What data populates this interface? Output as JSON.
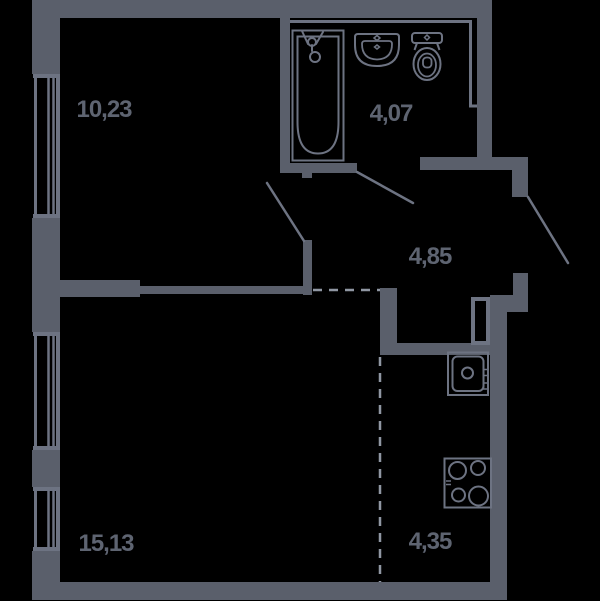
{
  "colors": {
    "bg": "#000000",
    "wall": "#5a5f6b",
    "line": "#6d7382",
    "dash": "#9097a3",
    "text": "#5e6471"
  },
  "floorplan": {
    "type": "apartment-floor-plan",
    "rooms": [
      {
        "id": "room-top-left",
        "label": "10,23",
        "area_m2": 10.23
      },
      {
        "id": "bathroom",
        "label": "4,07",
        "area_m2": 4.07
      },
      {
        "id": "hallway",
        "label": "4,85",
        "area_m2": 4.85
      },
      {
        "id": "room-bottom-left",
        "label": "15,13",
        "area_m2": 15.13
      },
      {
        "id": "kitchen",
        "label": "4,35",
        "area_m2": 4.35
      }
    ],
    "fixtures": [
      "bathtub-icon",
      "bathroom-sink-icon",
      "toilet-icon",
      "kitchen-sink-icon",
      "stove-icon",
      "vent-shaft"
    ],
    "openings": [
      "window-1",
      "window-2",
      "window-3",
      "door-room-top-left",
      "door-bathroom",
      "door-entrance"
    ]
  }
}
